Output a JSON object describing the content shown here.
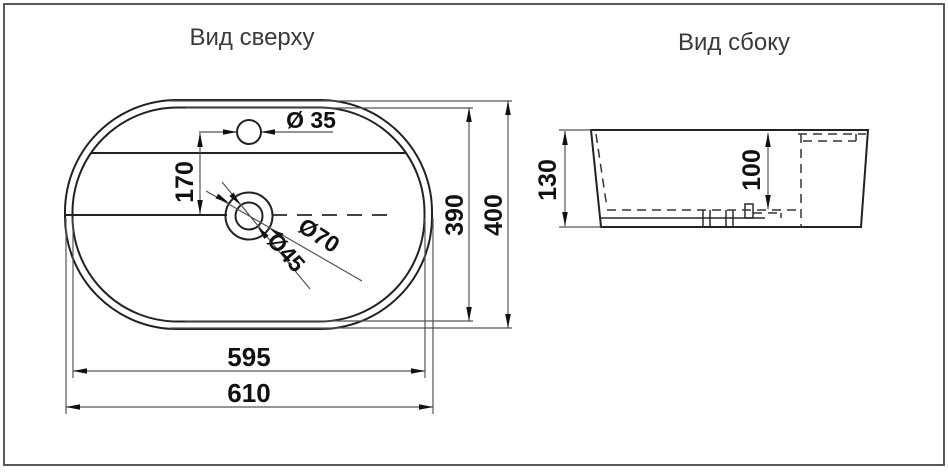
{
  "titles": {
    "top_view": "Вид сверху",
    "side_view": "Вид сбоку"
  },
  "top_view": {
    "labels": {
      "faucet_hole_diameter": "Ø 35",
      "faucet_to_drain_offset": "170",
      "drain_recess_diameter": "Ø70",
      "drain_hole_diameter": "Ø45",
      "basin_inner_width": "390",
      "overall_width": "400",
      "basin_inner_length": "595",
      "overall_length": "610"
    }
  },
  "side_view": {
    "labels": {
      "overall_height": "130",
      "bowl_depth": "100"
    }
  },
  "colors": {
    "background": "#ffffff",
    "outline": "#222222",
    "dimension_line": "#555555",
    "dimension_text": "#111111",
    "title_text": "#3a3a3a",
    "border": "#474747"
  }
}
